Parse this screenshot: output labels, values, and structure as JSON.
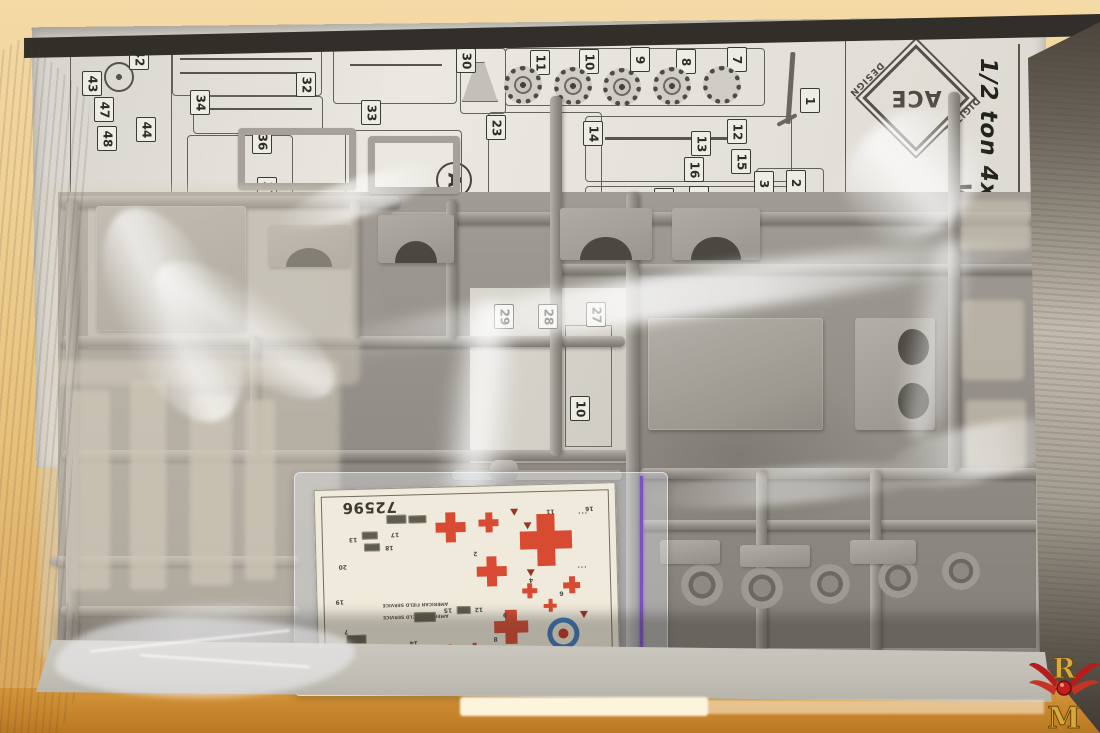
{
  "branding": {
    "logo_text": "ACE",
    "logo_design": "DESIGN",
    "logo_digital": "DIGITAL",
    "kit_title": "1/2 ton 4x4",
    "kit_title_partial": "W"
  },
  "instruction_sheet": {
    "sprue_letter": "A",
    "part_labels": [
      {
        "n": "42",
        "x": 139,
        "y": 58
      },
      {
        "n": "43",
        "x": 92,
        "y": 84
      },
      {
        "n": "47",
        "x": 104,
        "y": 110
      },
      {
        "n": "48",
        "x": 107,
        "y": 139
      },
      {
        "n": "44",
        "x": 146,
        "y": 130
      },
      {
        "n": "34",
        "x": 200,
        "y": 103
      },
      {
        "n": "36",
        "x": 262,
        "y": 142
      },
      {
        "n": "32",
        "x": 306,
        "y": 85
      },
      {
        "n": "33",
        "x": 371,
        "y": 113
      },
      {
        "n": "37",
        "x": 267,
        "y": 190
      },
      {
        "n": "30",
        "x": 466,
        "y": 61
      },
      {
        "n": "23",
        "x": 496,
        "y": 128
      },
      {
        "n": "11",
        "x": 540,
        "y": 63
      },
      {
        "n": "10",
        "x": 589,
        "y": 62
      },
      {
        "n": "9",
        "x": 640,
        "y": 60
      },
      {
        "n": "8",
        "x": 686,
        "y": 62
      },
      {
        "n": "7",
        "x": 737,
        "y": 60
      },
      {
        "n": "14",
        "x": 593,
        "y": 134
      },
      {
        "n": "13",
        "x": 701,
        "y": 144
      },
      {
        "n": "12",
        "x": 737,
        "y": 132
      },
      {
        "n": "16",
        "x": 694,
        "y": 170
      },
      {
        "n": "15",
        "x": 741,
        "y": 162
      },
      {
        "n": "17",
        "x": 699,
        "y": 199
      },
      {
        "n": "18",
        "x": 664,
        "y": 201
      },
      {
        "n": "19",
        "x": 636,
        "y": 208
      },
      {
        "n": "2",
        "x": 796,
        "y": 183
      },
      {
        "n": "3",
        "x": 764,
        "y": 184
      },
      {
        "n": "1",
        "x": 810,
        "y": 101
      },
      {
        "n": "24",
        "x": 503,
        "y": 235
      }
    ],
    "part_labels_under": [
      {
        "n": "29",
        "x": 504,
        "y": 317
      },
      {
        "n": "28",
        "x": 548,
        "y": 317
      },
      {
        "n": "27",
        "x": 596,
        "y": 315
      },
      {
        "n": "10",
        "x": 580,
        "y": 409
      }
    ]
  },
  "figures": {
    "wheels": [
      {
        "x": 523,
        "y": 85
      },
      {
        "x": 573,
        "y": 86
      },
      {
        "x": 622,
        "y": 87
      },
      {
        "x": 672,
        "y": 86
      },
      {
        "x": 722,
        "y": 85,
        "plain": true
      }
    ],
    "panels": [
      {
        "x": 70,
        "y": 40,
        "w": 100,
        "h": 178,
        "r": 12
      },
      {
        "x": 172,
        "y": 40,
        "w": 148,
        "h": 54,
        "r": 4
      },
      {
        "x": 193,
        "y": 96,
        "w": 128,
        "h": 36,
        "r": 4
      },
      {
        "x": 187,
        "y": 135,
        "w": 104,
        "h": 82,
        "r": 4
      },
      {
        "x": 333,
        "y": 40,
        "w": 122,
        "h": 62,
        "r": 4
      },
      {
        "x": 460,
        "y": 48,
        "w": 44,
        "h": 64,
        "r": 4
      },
      {
        "x": 505,
        "y": 48,
        "w": 258,
        "h": 56,
        "r": 4
      },
      {
        "x": 488,
        "y": 112,
        "w": 112,
        "h": 96,
        "r": 4
      },
      {
        "x": 585,
        "y": 116,
        "w": 205,
        "h": 64,
        "r": 4
      },
      {
        "x": 585,
        "y": 186,
        "w": 205,
        "h": 72,
        "r": 4
      },
      {
        "x": 756,
        "y": 168,
        "w": 66,
        "h": 58,
        "r": 4
      },
      {
        "x": 345,
        "y": 130,
        "w": 115,
        "h": 100,
        "r": 4
      }
    ],
    "lines": [
      {
        "x": 845,
        "y": 30,
        "w": 1,
        "h": 178
      },
      {
        "x": 1018,
        "y": 44,
        "w": 2,
        "h": 196
      },
      {
        "x": 200,
        "y": 108,
        "w": 112,
        "h": 2
      },
      {
        "x": 350,
        "y": 64,
        "w": 92,
        "h": 2
      },
      {
        "x": 605,
        "y": 137,
        "w": 132,
        "h": 3
      },
      {
        "x": 180,
        "y": 58,
        "w": 132,
        "h": 2
      },
      {
        "x": 180,
        "y": 72,
        "w": 132,
        "h": 2
      }
    ],
    "rails_h": [
      {
        "x": 60,
        "y": 196,
        "w": 340,
        "h": 12
      },
      {
        "x": 390,
        "y": 212,
        "w": 665,
        "h": 12
      },
      {
        "x": 556,
        "y": 264,
        "w": 494,
        "h": 10
      },
      {
        "x": 60,
        "y": 336,
        "w": 565,
        "h": 11
      },
      {
        "x": 62,
        "y": 450,
        "w": 575,
        "h": 11
      },
      {
        "x": 640,
        "y": 468,
        "w": 412,
        "h": 11
      },
      {
        "x": 640,
        "y": 520,
        "w": 405,
        "h": 10
      },
      {
        "x": 300,
        "y": 648,
        "w": 740,
        "h": 12
      },
      {
        "x": 50,
        "y": 556,
        "w": 250,
        "h": 10
      },
      {
        "x": 60,
        "y": 606,
        "w": 240,
        "h": 10
      }
    ],
    "rails_v": [
      {
        "x": 66,
        "y": 200,
        "w": 12,
        "h": 450
      },
      {
        "x": 550,
        "y": 96,
        "w": 12,
        "h": 360
      },
      {
        "x": 626,
        "y": 192,
        "w": 13,
        "h": 468
      },
      {
        "x": 948,
        "y": 92,
        "w": 12,
        "h": 380
      },
      {
        "x": 1036,
        "y": 150,
        "w": 13,
        "h": 505
      },
      {
        "x": 446,
        "y": 200,
        "w": 11,
        "h": 140
      },
      {
        "x": 756,
        "y": 470,
        "w": 11,
        "h": 190
      },
      {
        "x": 870,
        "y": 470,
        "w": 11,
        "h": 190
      },
      {
        "x": 250,
        "y": 336,
        "w": 10,
        "h": 120
      },
      {
        "x": 350,
        "y": 200,
        "w": 10,
        "h": 140
      }
    ],
    "parts": [
      {
        "k": "panel",
        "x": 96,
        "y": 206,
        "w": 150,
        "h": 125
      },
      {
        "k": "arc",
        "x": 268,
        "y": 225,
        "w": 82,
        "h": 42
      },
      {
        "k": "arc",
        "x": 378,
        "y": 215,
        "w": 76,
        "h": 48
      },
      {
        "k": "frame",
        "x": 238,
        "y": 128,
        "w": 118,
        "h": 62
      },
      {
        "k": "frame",
        "x": 368,
        "y": 136,
        "w": 92,
        "h": 58
      },
      {
        "k": "arc",
        "x": 560,
        "y": 208,
        "w": 92,
        "h": 52
      },
      {
        "k": "arc",
        "x": 672,
        "y": 208,
        "w": 88,
        "h": 52
      },
      {
        "k": "panel",
        "x": 648,
        "y": 318,
        "w": 175,
        "h": 112
      },
      {
        "k": "dholes",
        "x": 855,
        "y": 318,
        "w": 80,
        "h": 112
      },
      {
        "k": "bar",
        "x": 452,
        "y": 470,
        "w": 170,
        "h": 10
      },
      {
        "k": "cyl",
        "x": 490,
        "y": 460,
        "w": 28,
        "h": 22
      },
      {
        "k": "ring",
        "x": 681,
        "y": 564,
        "w": 42,
        "h": 42
      },
      {
        "k": "ring",
        "x": 741,
        "y": 567,
        "w": 42,
        "h": 42
      },
      {
        "k": "ring",
        "x": 810,
        "y": 564,
        "w": 40,
        "h": 40
      },
      {
        "k": "ring",
        "x": 878,
        "y": 558,
        "w": 40,
        "h": 40
      },
      {
        "k": "ring",
        "x": 942,
        "y": 552,
        "w": 38,
        "h": 38
      },
      {
        "k": "ghost",
        "x": 70,
        "y": 390,
        "w": 40,
        "h": 200
      },
      {
        "k": "ghost",
        "x": 130,
        "y": 380,
        "w": 36,
        "h": 210
      },
      {
        "k": "ghost",
        "x": 190,
        "y": 395,
        "w": 42,
        "h": 190
      },
      {
        "k": "ghost",
        "x": 245,
        "y": 400,
        "w": 30,
        "h": 180
      },
      {
        "k": "block",
        "x": 660,
        "y": 540,
        "w": 60,
        "h": 24
      },
      {
        "k": "block",
        "x": 740,
        "y": 545,
        "w": 70,
        "h": 22
      },
      {
        "k": "block",
        "x": 850,
        "y": 540,
        "w": 66,
        "h": 24
      },
      {
        "k": "ghost",
        "x": 960,
        "y": 200,
        "w": 70,
        "h": 50
      },
      {
        "k": "ghost",
        "x": 962,
        "y": 300,
        "w": 62,
        "h": 80
      },
      {
        "k": "ghost",
        "x": 966,
        "y": 400,
        "w": 60,
        "h": 70
      },
      {
        "k": "block",
        "x": 320,
        "y": 560,
        "w": 60,
        "h": 40
      },
      {
        "k": "block",
        "x": 400,
        "y": 565,
        "w": 70,
        "h": 36
      }
    ],
    "streaks": [
      {
        "x": 310,
        "y": 272,
        "w": 740,
        "h": 46,
        "r": -8,
        "o": 0.85,
        "b": 6
      },
      {
        "x": 118,
        "y": 200,
        "w": 110,
        "h": 230,
        "r": -25,
        "o": 0.7,
        "b": 3
      },
      {
        "x": 205,
        "y": 225,
        "w": 80,
        "h": 210,
        "r": -55,
        "o": 0.6,
        "b": 3
      },
      {
        "x": 438,
        "y": 300,
        "w": 70,
        "h": 340,
        "r": 6,
        "o": 0.8,
        "b": 8
      },
      {
        "x": 838,
        "y": 115,
        "w": 150,
        "h": 120,
        "r": -40,
        "o": 0.75,
        "b": 5
      },
      {
        "x": 880,
        "y": 425,
        "w": 200,
        "h": 55,
        "r": -12,
        "o": 0.55,
        "b": 4
      },
      {
        "x": 55,
        "y": 608,
        "w": 290,
        "h": 72,
        "r": -4,
        "o": 0.7,
        "b": 5
      },
      {
        "x": 640,
        "y": 468,
        "w": 300,
        "h": 36,
        "r": -5,
        "o": 0.45,
        "b": 4
      },
      {
        "x": 275,
        "y": 178,
        "w": 170,
        "h": 38,
        "r": -18,
        "o": 0.65,
        "b": 3
      },
      {
        "x": 905,
        "y": 240,
        "w": 60,
        "h": 200,
        "r": 10,
        "o": 0.5,
        "b": 6
      }
    ]
  },
  "decal_sheet": {
    "code": "72596",
    "service_lines": [
      "AMERICAN FIELD SERVICE",
      "AMERICAN FIELD SERVICE"
    ],
    "crosses": [
      {
        "x": 136,
        "y": 41,
        "s": 30
      },
      {
        "x": 174,
        "y": 37,
        "s": 20
      },
      {
        "x": 231,
        "y": 56,
        "s": 52
      },
      {
        "x": 176,
        "y": 86,
        "s": 30
      },
      {
        "x": 213,
        "y": 106,
        "s": 15
      },
      {
        "x": 255,
        "y": 101,
        "s": 17
      },
      {
        "x": 233,
        "y": 121,
        "s": 13
      },
      {
        "x": 194,
        "y": 142,
        "s": 34
      },
      {
        "x": 132,
        "y": 164,
        "s": 12
      },
      {
        "x": 157,
        "y": 163,
        "s": 12
      }
    ],
    "numbers": [
      {
        "t": "13",
        "x": 34,
        "y": 47
      },
      {
        "t": "17",
        "x": 76,
        "y": 43
      },
      {
        "t": "18",
        "x": 70,
        "y": 56
      },
      {
        "t": "20",
        "x": 23,
        "y": 74
      },
      {
        "t": "19",
        "x": 19,
        "y": 109
      },
      {
        "t": "7",
        "x": 27,
        "y": 139
      },
      {
        "t": "14",
        "x": 92,
        "y": 152
      },
      {
        "t": "2",
        "x": 158,
        "y": 64
      },
      {
        "t": "12",
        "x": 158,
        "y": 120
      },
      {
        "t": "15",
        "x": 127,
        "y": 120
      },
      {
        "t": "4",
        "x": 213,
        "y": 92
      },
      {
        "t": "6",
        "x": 243,
        "y": 106
      },
      {
        "t": "9",
        "x": 186,
        "y": 126
      },
      {
        "t": "8",
        "x": 176,
        "y": 150
      },
      {
        "t": "11",
        "x": 232,
        "y": 24
      },
      {
        "t": "16",
        "x": 271,
        "y": 22
      },
      {
        "t": "16",
        "x": 274,
        "y": 168
      }
    ],
    "chips": [
      {
        "x": 72,
        "y": 27,
        "w": 20,
        "h": 9
      },
      {
        "x": 94,
        "y": 28,
        "w": 18,
        "h": 8
      },
      {
        "x": 47,
        "y": 43,
        "w": 16,
        "h": 8
      },
      {
        "x": 49,
        "y": 55,
        "w": 16,
        "h": 8
      },
      {
        "x": 97,
        "y": 125,
        "w": 22,
        "h": 10
      },
      {
        "x": 29,
        "y": 146,
        "w": 20,
        "h": 9
      },
      {
        "x": 30,
        "y": 162,
        "w": 20,
        "h": 9
      },
      {
        "x": 140,
        "y": 120,
        "w": 14,
        "h": 8
      }
    ],
    "planes": [
      {
        "x": 209,
        "y": 38
      },
      {
        "x": 211,
        "y": 85
      },
      {
        "x": 263,
        "y": 128
      },
      {
        "x": 196,
        "y": 24
      }
    ],
    "dot_groups": [
      {
        "x": 263,
        "y": 26,
        "t": "···"
      },
      {
        "x": 261,
        "y": 80,
        "t": "···"
      }
    ],
    "roundel": {
      "x": 246,
      "y": 150
    }
  },
  "watermark": {
    "top": "R",
    "bottom": "M"
  },
  "colors": {
    "decal_red": "#d84b32",
    "roundel_blue": "#3e78bb",
    "roundel_center": "#cc3322",
    "zip_purple": "#7b52c4",
    "table_amber": "#d49539",
    "sprue_grey": "#a09c95",
    "sheet_white": "#e8e5de",
    "watermark_gold": "#d8a93c",
    "watermark_red": "#b51d1d"
  }
}
